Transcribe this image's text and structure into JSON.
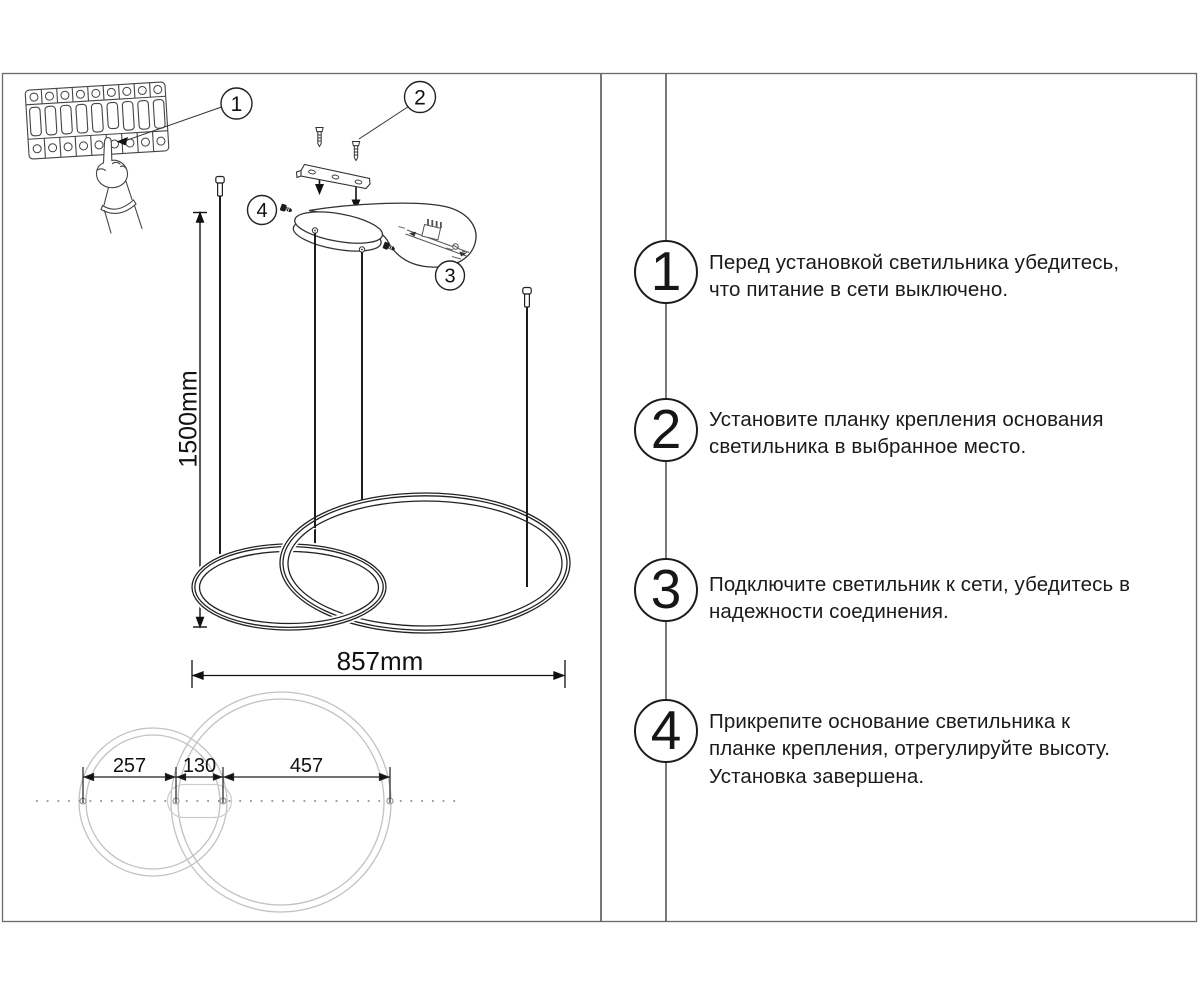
{
  "callouts": {
    "breaker": "1",
    "bracket": "2",
    "wiring": "3",
    "canopy": "4"
  },
  "dimensions": {
    "drop": "1500mm",
    "width": "857mm",
    "d1": "257",
    "d2": "130",
    "d3": "457"
  },
  "steps": [
    {
      "num": "1",
      "lines": [
        "Перед установкой светильника убедитесь,",
        "что питание в сети выключено."
      ]
    },
    {
      "num": "2",
      "lines": [
        "Установите планку крепления основания",
        "светильника в выбранное место."
      ]
    },
    {
      "num": "3",
      "lines": [
        "Подключите светильник к сети, убедитесь в",
        "надежности соединения."
      ]
    },
    {
      "num": "4",
      "lines": [
        "Прикрепите основание светильника к",
        "планке крепления, отрегулируйте высоту.",
        "Установка завершена."
      ]
    }
  ]
}
